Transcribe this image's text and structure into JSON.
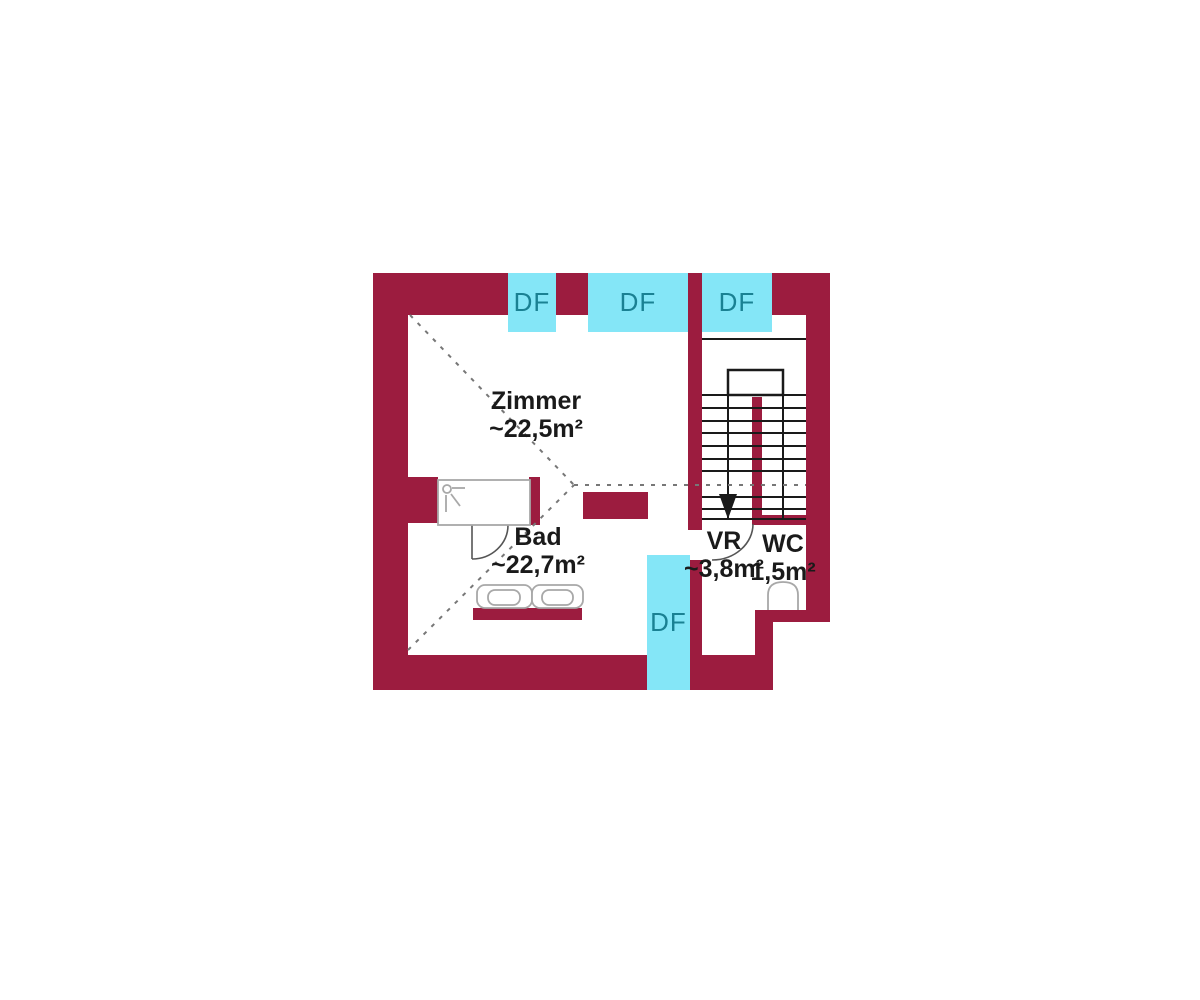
{
  "rooms": [
    {
      "id": "zimmer",
      "name": "Zimmer",
      "area": "~22,5m²"
    },
    {
      "id": "bad",
      "name": "Bad",
      "area": "~22,7m²"
    },
    {
      "id": "vr",
      "name": "VR",
      "area": "~3,8m²"
    },
    {
      "id": "wc",
      "name": "WC",
      "area": "1,5m²"
    }
  ],
  "windows": [
    {
      "label": "DF"
    },
    {
      "label": "DF"
    },
    {
      "label": "DF"
    },
    {
      "label": "DF"
    }
  ],
  "stairs": {
    "direction": "down-arrow"
  },
  "colors": {
    "wall": "#9C1C3F",
    "window": "#84E6F7",
    "window_label": "#1A8193",
    "line": "#1A1A1A",
    "dash": "#777777",
    "fixture": "#A8A8A8",
    "door": "#555555",
    "text": "#1A1A1A",
    "background": "#FFFFFF"
  }
}
